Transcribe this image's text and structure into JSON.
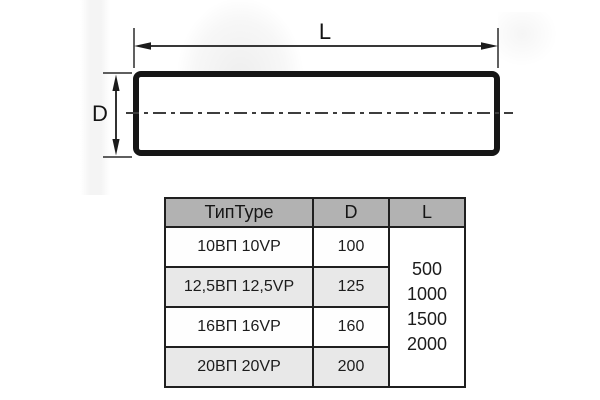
{
  "diagram": {
    "length_label": "L",
    "diameter_label": "D"
  },
  "table": {
    "headers": {
      "type": "ТипType",
      "d": "D",
      "l": "L"
    },
    "rows": [
      {
        "type": "10ВП 10VP",
        "d": "100"
      },
      {
        "type": "12,5ВП 12,5VP",
        "d": "125"
      },
      {
        "type": "16ВП 16VP",
        "d": "160"
      },
      {
        "type": "20ВП 20VP",
        "d": "200"
      }
    ],
    "l_values": [
      "500",
      "1000",
      "1500",
      "2000"
    ]
  },
  "colors": {
    "table_header_bg": "#b2b2b2",
    "table_alt_row_bg": "#e8e8e8",
    "line_color": "#1a1a1a",
    "background": "#ffffff"
  }
}
